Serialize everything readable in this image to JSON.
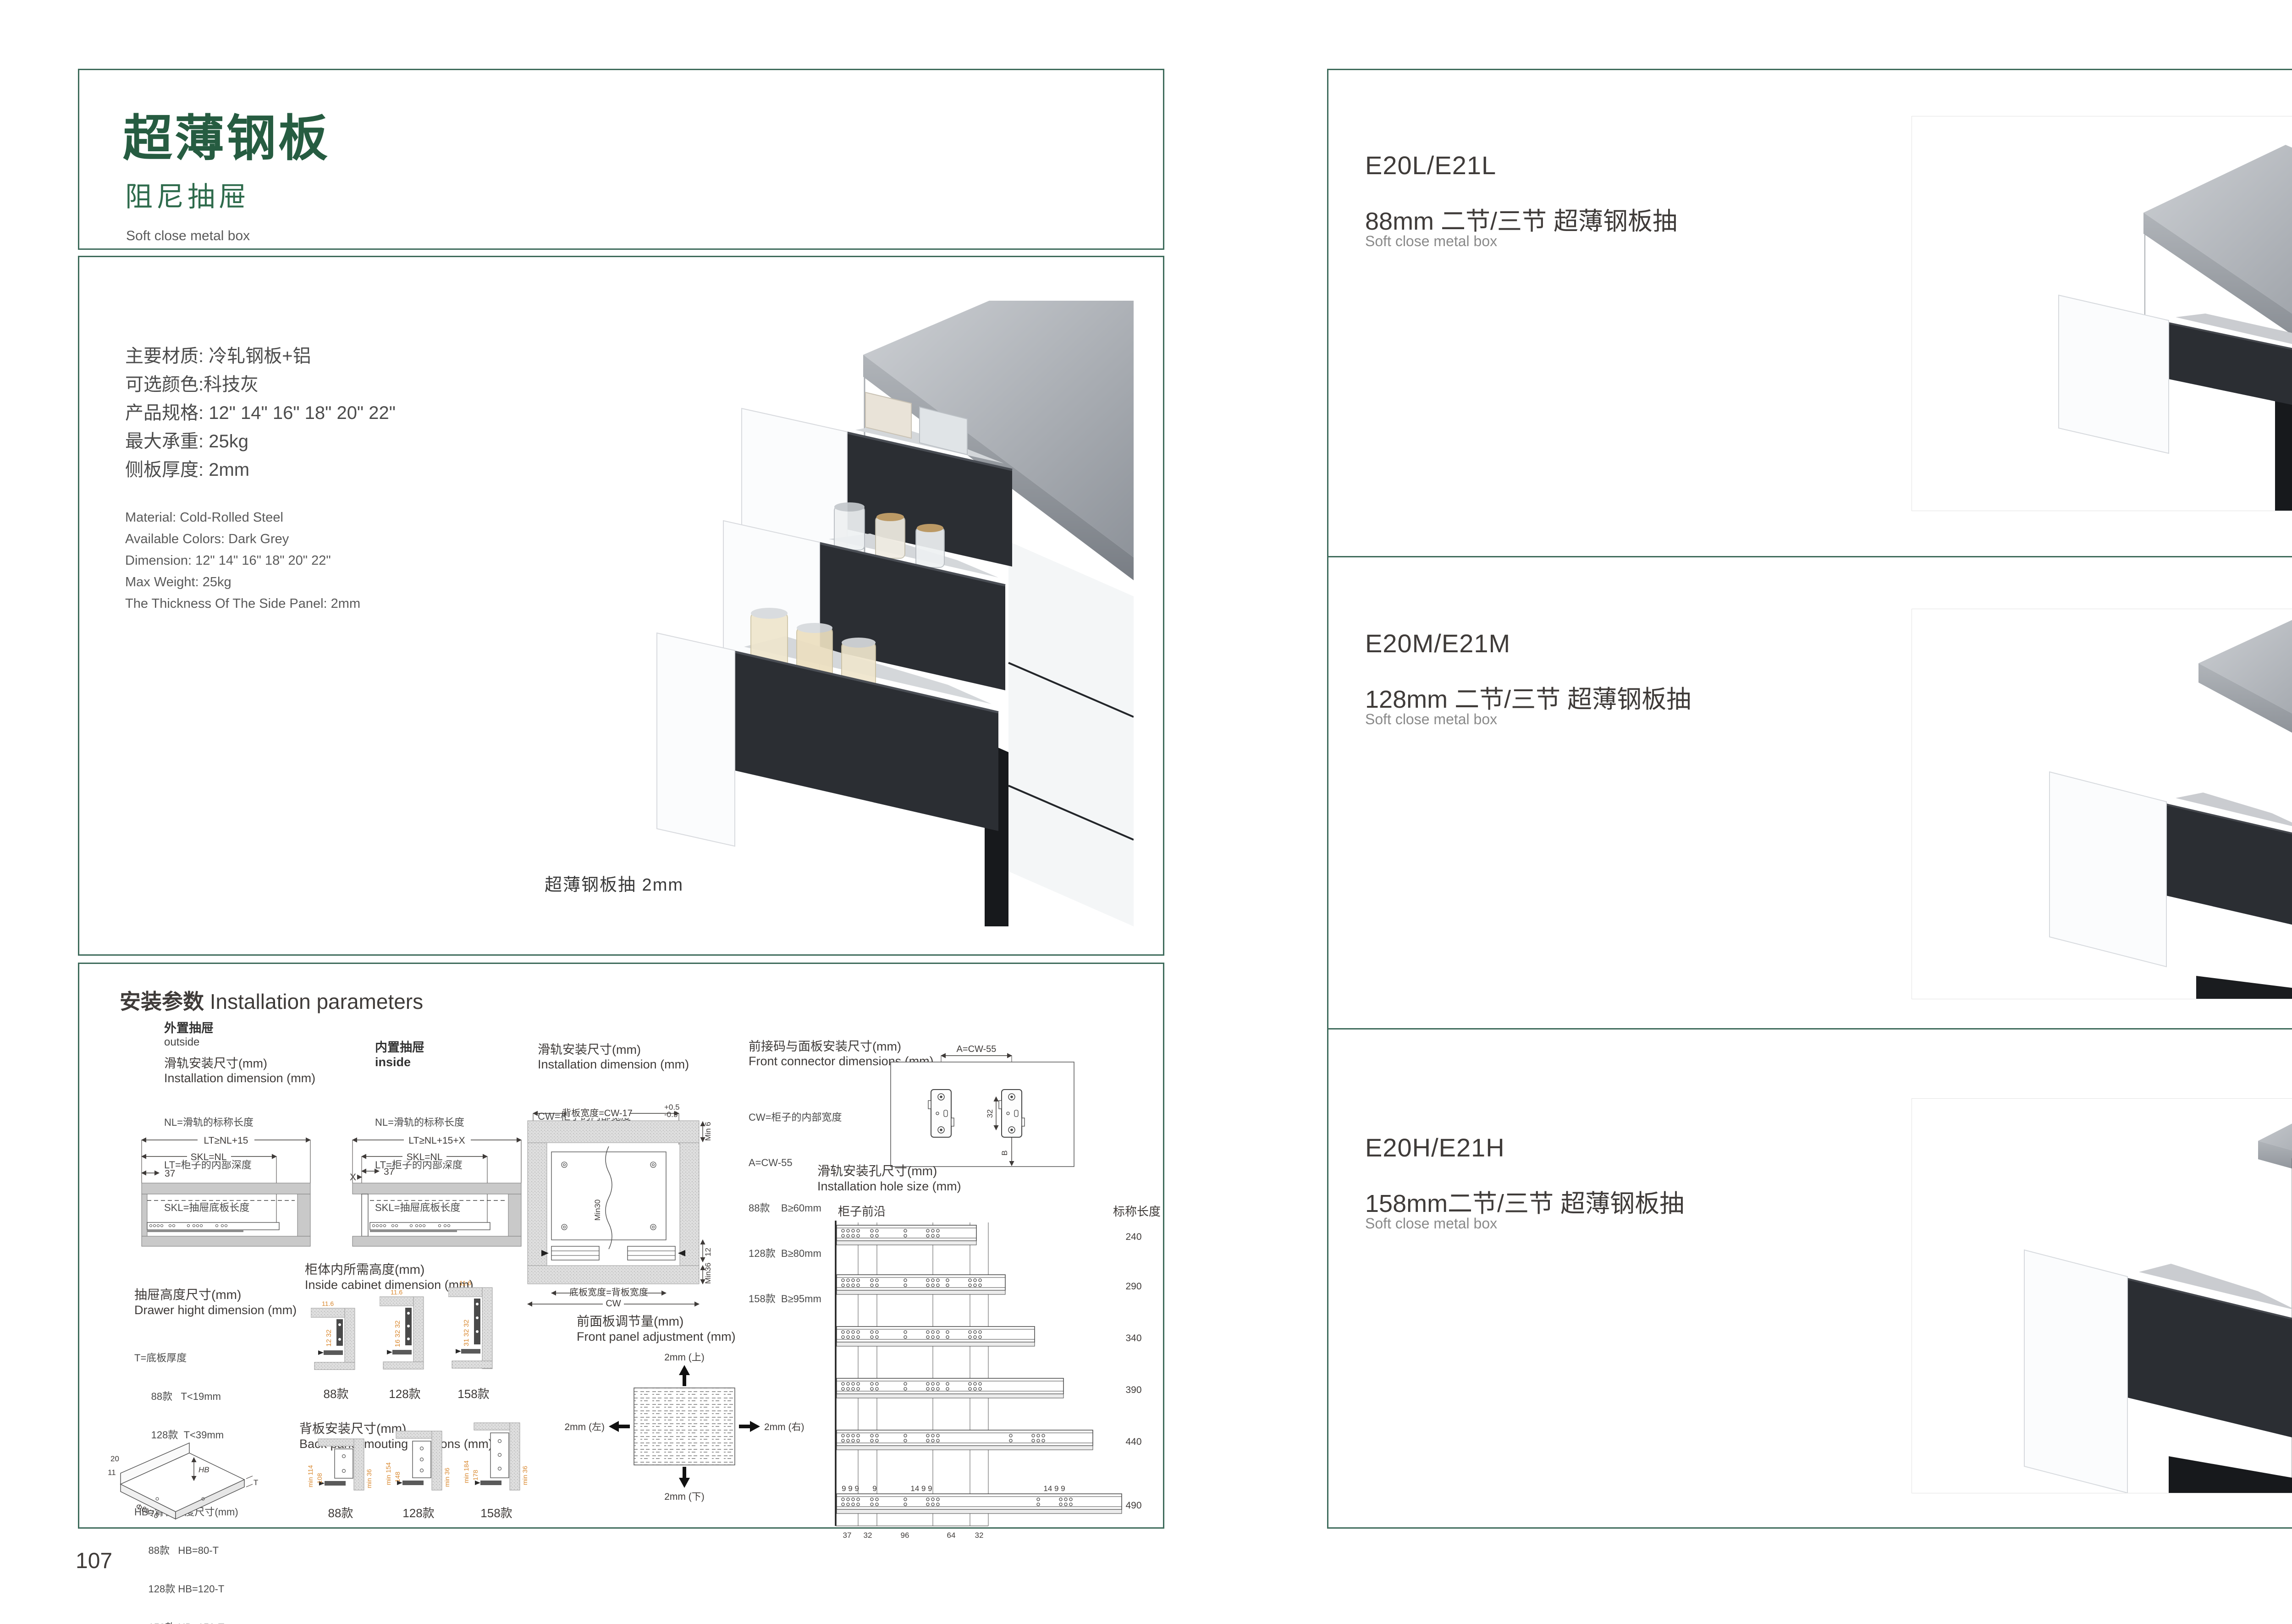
{
  "colors": {
    "accent_green": "#265C41",
    "border_green": "#3E6B5B",
    "dim_orange": "#D9882F",
    "text_dark": "#3F3B39"
  },
  "left_page": {
    "page_number": "107",
    "header": {
      "title_cn": "超薄钢板",
      "subtitle_cn": "阻尼抽屉",
      "subtitle_en": "Soft close metal box"
    },
    "product": {
      "specs_cn": [
        "主要材质: 冷轧钢板+铝",
        "可选颜色:科技灰",
        "产品规格: 12\" 14\" 16\" 18\" 20\" 22\"",
        "最大承重: 25kg",
        "侧板厚度: 2mm"
      ],
      "specs_en": [
        "Material: Cold-Rolled Steel",
        "Available Colors: Dark Grey",
        "Dimension: 12\" 14\" 16\" 18\" 20\" 22\"",
        "Max Weight: 25kg",
        "The Thickness Of The Side Panel: 2mm"
      ],
      "photo_caption": "超薄钢板抽 2mm"
    },
    "install": {
      "title_cn": "安装参数",
      "title_en": "Installation parameters",
      "outside": {
        "head_cn": "外置抽屉",
        "head_en": "outside",
        "sub_cn": "滑轨安装尺寸(mm)",
        "sub_en": "Installation dimension (mm)",
        "legend": [
          "NL=滑轨的标称长度",
          "LT=柜子的内部深度",
          "SKL=抽屉底板长度"
        ],
        "dim_top": "LT≥NL+15",
        "dim_mid": "SKL=NL",
        "dim_front": "37"
      },
      "inside": {
        "head_cn": "内置抽屉",
        "head_en": "inside",
        "legend": [
          "NL=滑轨的标称长度",
          "LT=柜子的内部深度",
          "SKL=抽屉底板长度"
        ],
        "dim_top": "LT≥NL+15+X",
        "dim_mid": "SKL=NL",
        "dim_front": "37",
        "dim_x": "X"
      },
      "cw": {
        "sub_cn": "滑轨安装尺寸(mm)",
        "sub_en": "Installation dimension (mm)",
        "legend": "CW=柜子的内部宽度",
        "dim_back_width": "背板宽度=CW-17",
        "tol_plus": "+0.5",
        "tol_minus": "-0.5",
        "dim_min6": "Min 6",
        "dim_min30": "Min30",
        "dim_12": "12",
        "dim_min36": "Min36",
        "dim_bottom_width": "底板宽度=背板宽度",
        "dim_cw": "CW"
      },
      "connector": {
        "title_cn": "前接码与面板安装尺寸(mm)",
        "title_en": "Front connector  dimensions (mm)",
        "legend": [
          "CW=柜子的内部宽度",
          "A=CW-55",
          "88款    B≥60mm",
          "128款  B≥80mm",
          "158款  B≥95mm"
        ],
        "dim_a": "A=CW-55",
        "dim_32": "32",
        "dim_b": "B"
      },
      "drawer_height": {
        "title_cn": "抽屉高度尺寸(mm)",
        "title_en": "Drawer hight dimension (mm)",
        "legend": [
          "T=底板厚度",
          "      88款   T<19mm",
          "      128款  T<39mm",
          "      158款  T<54mm",
          "HB=背板高度尺寸(mm)",
          "     88款   HB=80-T",
          "     128款 HB=120-T",
          "     158款 HB=150-T"
        ],
        "iso": {
          "d20": "20",
          "d11": "11",
          "hole": "Φ6X10",
          "hb": "HB",
          "t": "T"
        }
      },
      "cabinet_height": {
        "title_cn": "柜体内所需高度(mm)",
        "title_en": "Inside cabinet dimension (mm)",
        "variants": [
          {
            "name": "88款",
            "top": "11.6",
            "side": "12 32"
          },
          {
            "name": "128款",
            "top": "11.6",
            "side": "16 32 32"
          },
          {
            "name": "158款",
            "top": "11.6",
            "side": "31 32 32"
          }
        ]
      },
      "front_adjust": {
        "title_cn": "前面板调节量(mm)",
        "title_en": "Front panel adjustment (mm)",
        "up": "2mm (上)",
        "down": "2mm (下)",
        "left": "2mm (左)",
        "right": "2mm (右)"
      },
      "back_panel": {
        "title_cn": "背板安装尺寸(mm)",
        "title_en": "Back panel mouting positions (mm)",
        "variants": [
          {
            "name": "88款",
            "outer": "min 114",
            "inner": "108",
            "wall": "min 36"
          },
          {
            "name": "128款",
            "outer": "min 154",
            "inner": "148",
            "wall": "min 36"
          },
          {
            "name": "158款",
            "outer": "min 184",
            "inner": "178",
            "wall": "min 36"
          }
        ]
      },
      "holes": {
        "title_cn": "滑轨安装孔尺寸(mm)",
        "title_en": "Installation hole size (mm)",
        "front_edge": "柜子前沿",
        "nominal": "标称长度",
        "lengths": [
          "240",
          "290",
          "340",
          "390",
          "440",
          "490"
        ],
        "top_dims": [
          "9 9 9",
          "9",
          "14 9 9",
          "14 9 9"
        ],
        "bottom_dims": [
          "37",
          "32",
          "96",
          "64",
          "32"
        ]
      }
    }
  },
  "right_page": {
    "page_number": "108",
    "sections": [
      {
        "code": "E20L/E21L",
        "name_cn": "88mm 二节/三节 超薄钢板抽",
        "name_en": "Soft close metal box"
      },
      {
        "code": "E20M/E21M",
        "name_cn": "128mm 二节/三节 超薄钢板抽",
        "name_en": "Soft close metal box"
      },
      {
        "code": "E20H/E21H",
        "name_cn": "158mm二节/三节 超薄钢板抽",
        "name_en": "Soft close metal box"
      }
    ]
  }
}
